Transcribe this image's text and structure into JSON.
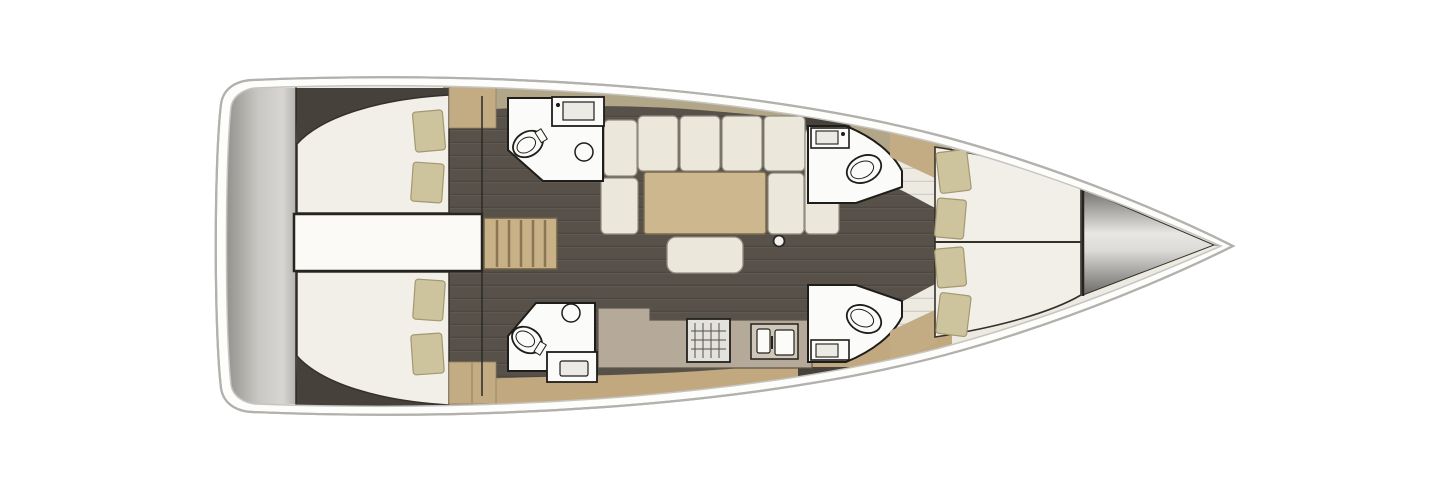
{
  "diagram": {
    "kind": "yacht-interior-floor-plan",
    "view": "top-down",
    "bow_direction": "right",
    "stern_direction": "left",
    "areas": [
      "swim-platform-transom",
      "aft-cabin-port",
      "aft-cabin-starboard",
      "engine-compartment",
      "companionway-stairs",
      "head-aft-port",
      "head-aft-starboard",
      "salon-sofa",
      "salon-table",
      "galley",
      "head-forward-port",
      "head-forward-starboard",
      "forward-v-berth-cabin",
      "anchor-locker"
    ]
  },
  "colors": {
    "background": "#ffffff",
    "hull_fill": "#fdfdfc",
    "hull_stroke": "#b3b1ad",
    "hull_inner_stroke": "#c6c5c1",
    "deck": "#edeae2",
    "deck_band_top": "#b2a689",
    "deck_band_bottom": "#c1a87e",
    "floor_dark": "#57514a",
    "wall_dark": "#46413a",
    "bed_cream": "#f1efe7",
    "cushion_cream": "#ebe7da",
    "pillow_khaki": "#cdc39d",
    "wood_tan": "#c3ac84",
    "counter_gray": "#b5aa99",
    "table_tan": "#ccb78e",
    "middle_band": "#fbfaf7",
    "stairs_tan": "#c8b187",
    "fixture_white": "#fbfbf9",
    "fixture_stroke": "#23211d"
  }
}
